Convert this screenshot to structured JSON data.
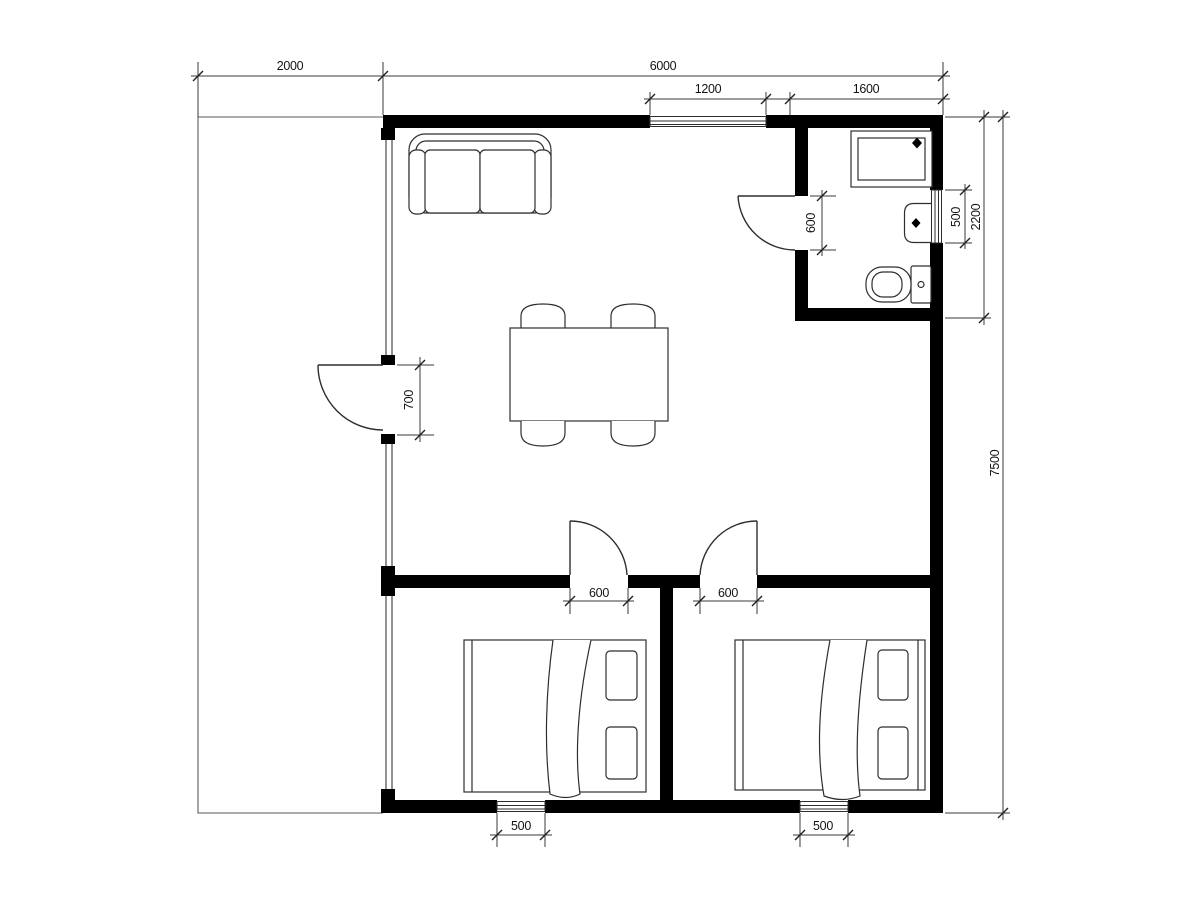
{
  "drawing": {
    "kind": "architectural floor plan",
    "units": "mm",
    "colors": {
      "wall": "#000000",
      "line": "#2e2e2e",
      "dimension": "#3a3a3a",
      "background": "#ffffff"
    },
    "symbols": [
      "sofa",
      "dining-table",
      "chair",
      "double-bed",
      "pillow",
      "shower-tray",
      "wash-basin",
      "toilet",
      "door-swing",
      "window"
    ]
  },
  "dims": {
    "porch_width": "2000",
    "main_width": "6000",
    "top_window": "1200",
    "bath_width": "1600",
    "right_window": "500",
    "bath_depth": "2200",
    "house_depth": "7500",
    "entry_door": "700",
    "bath_door": "600",
    "bed1_door": "600",
    "bed2_door": "600",
    "bed1_window": "500",
    "bed2_window": "500"
  }
}
